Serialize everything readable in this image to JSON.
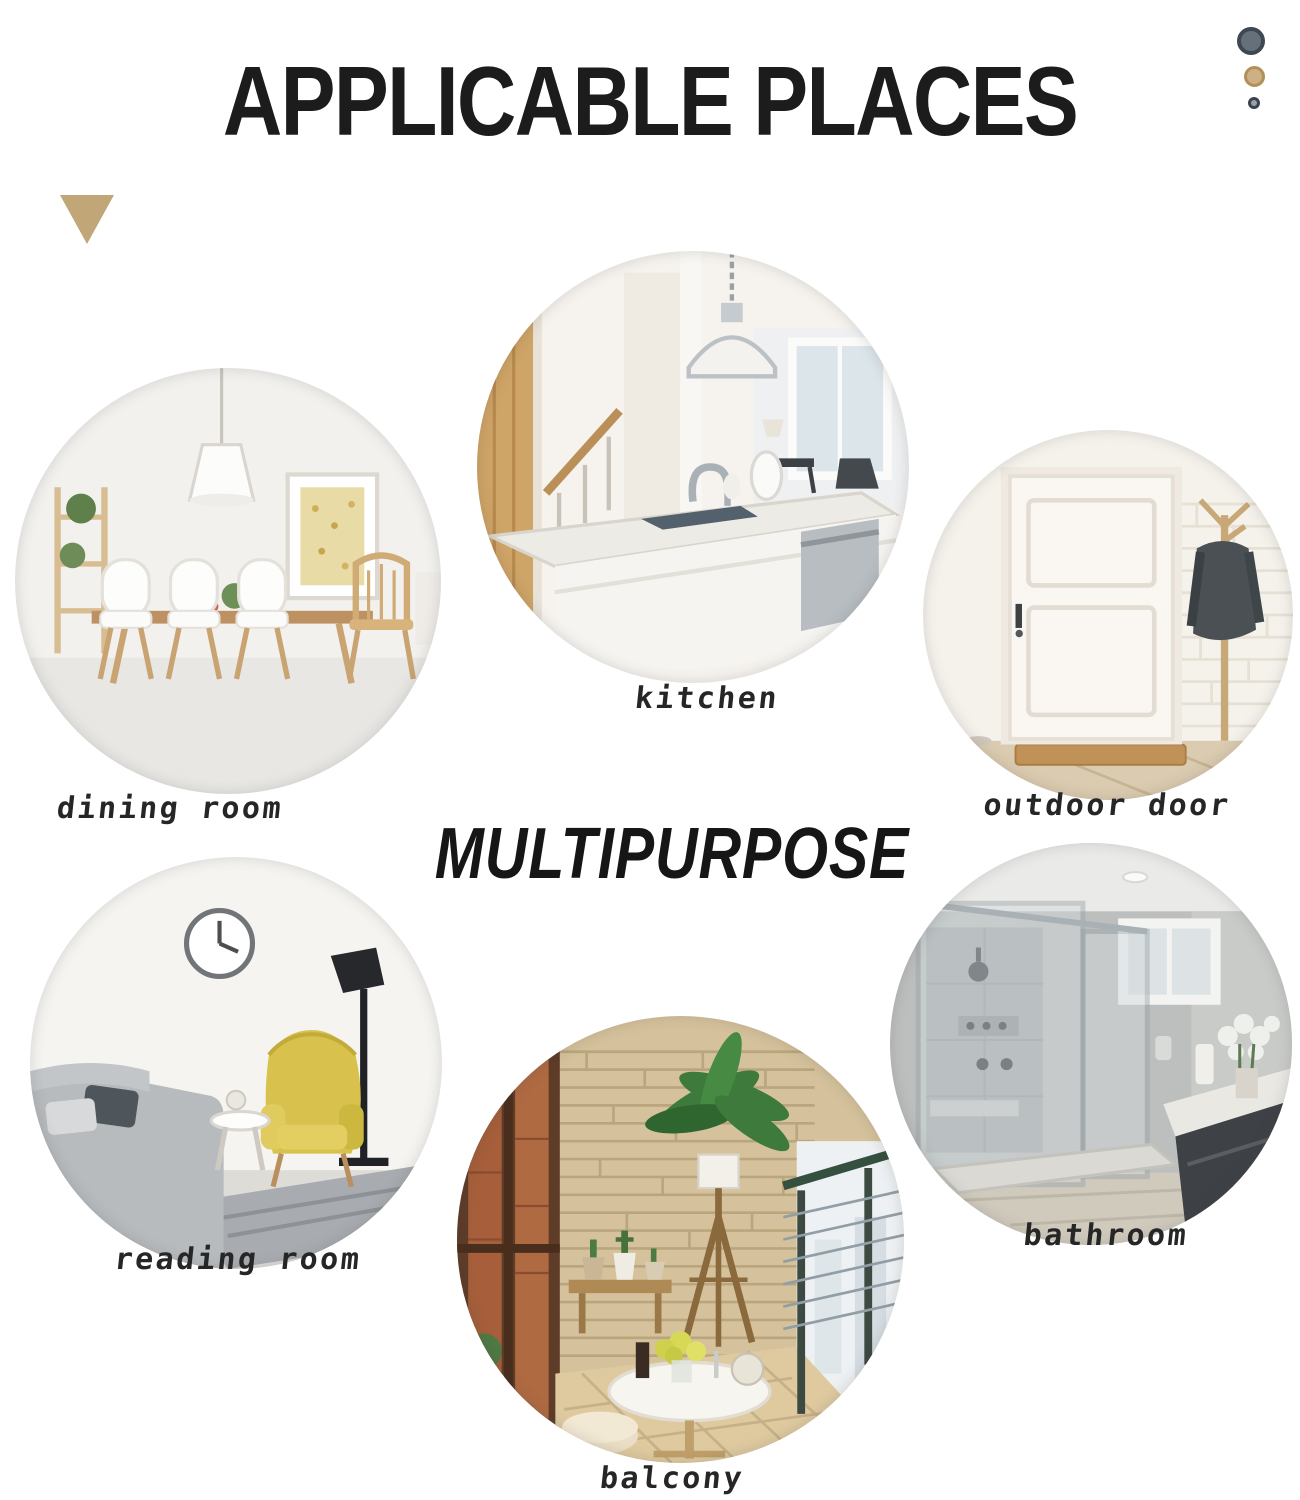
{
  "page": {
    "title": "APPLICABLE PLACES",
    "center_text": "MULTIPURPOSE"
  },
  "places": [
    {
      "id": "dining-room",
      "label": "dining room"
    },
    {
      "id": "kitchen",
      "label": "kitchen"
    },
    {
      "id": "outdoor-door",
      "label": "outdoor door"
    },
    {
      "id": "reading-room",
      "label": "reading room"
    },
    {
      "id": "bathroom",
      "label": "bathroom"
    },
    {
      "id": "balcony",
      "label": "balcony"
    }
  ],
  "decor": {
    "triangle": {
      "name": "triangle-down",
      "color": "#c1a678"
    },
    "dots": [
      {
        "name": "dot-large",
        "fill": "#66707a",
        "ring": "#3f4752"
      },
      {
        "name": "dot-medium",
        "fill": "#cdb083",
        "ring": "#b29159"
      },
      {
        "name": "dot-small",
        "fill": "#9aa0a6",
        "ring": "#3a424e"
      }
    ],
    "title_color": "#1c1c1c",
    "label_color": "#262626",
    "background_color": "#ffffff"
  }
}
